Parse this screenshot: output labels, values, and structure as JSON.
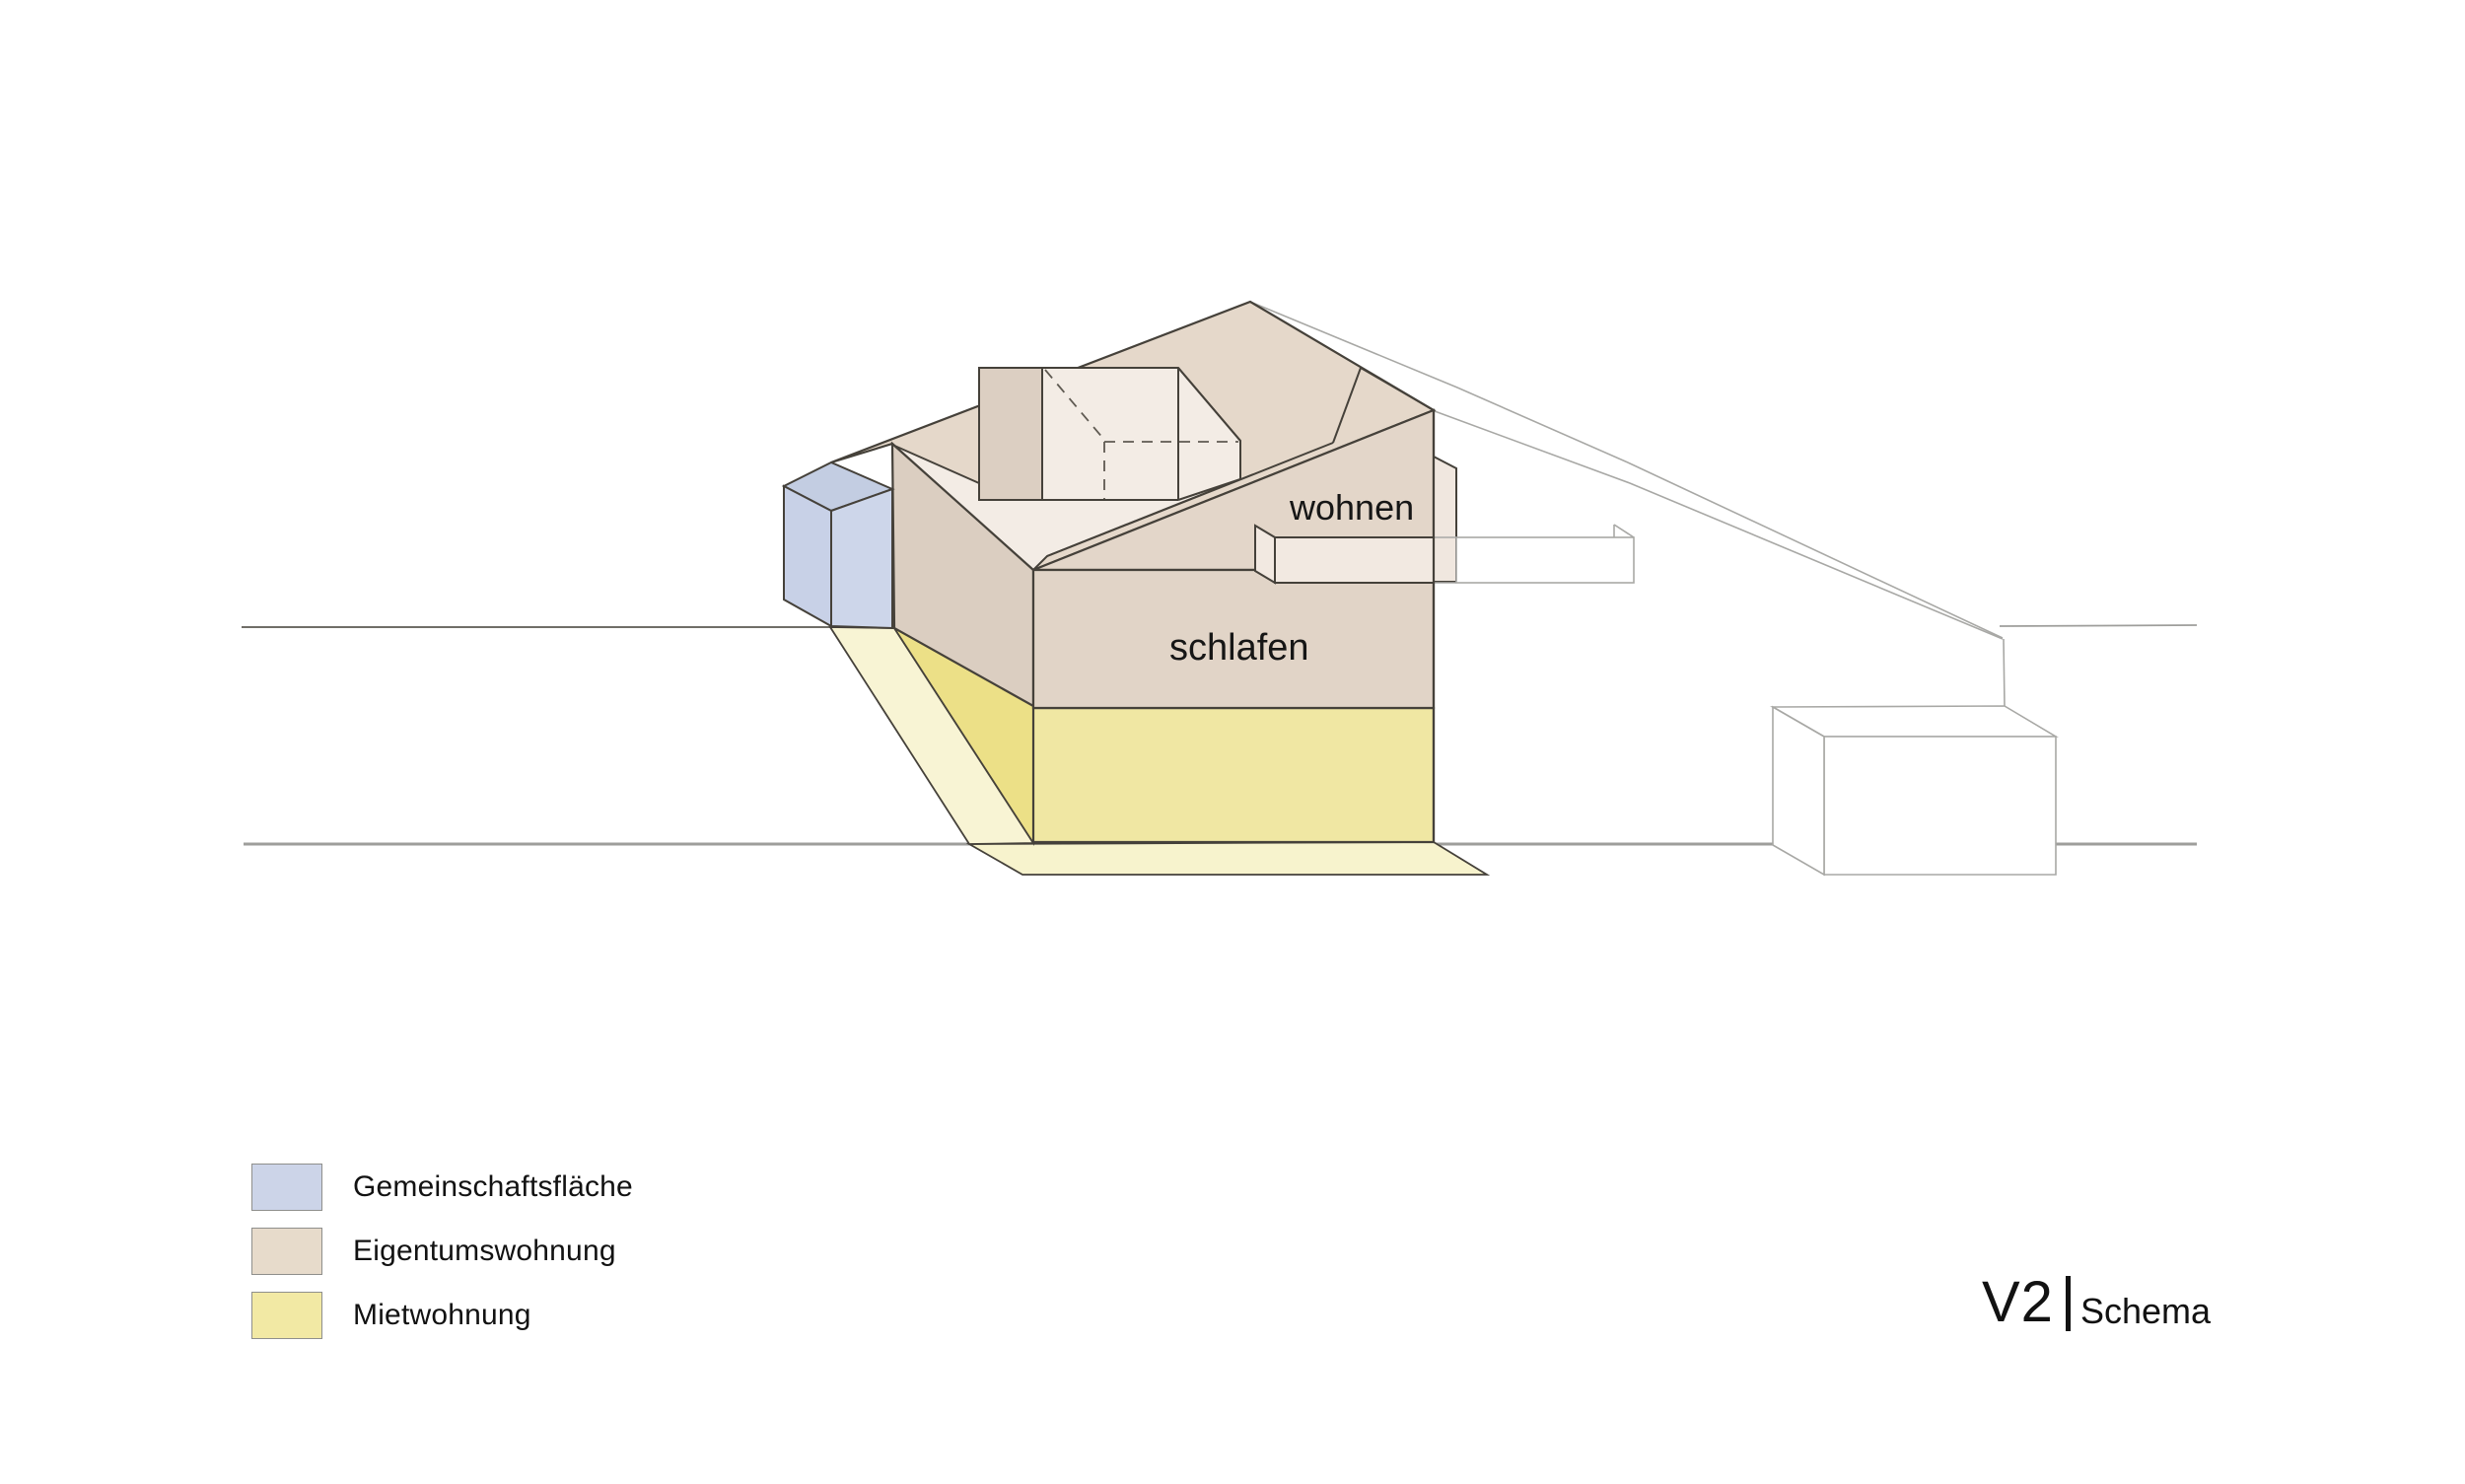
{
  "diagram": {
    "labels": {
      "living": "wohnen",
      "sleeping": "schlafen"
    }
  },
  "legend": {
    "items": [
      {
        "label": "Gemeinschaftsfläche",
        "color": "#ccd4e8"
      },
      {
        "label": "Eigentumswohnung",
        "color": "#e7dbcb"
      },
      {
        "label": "Mietwohnung",
        "color": "#f2e9a4"
      }
    ]
  },
  "title": {
    "version": "V2",
    "separator": "|",
    "name": "Schema"
  },
  "colors": {
    "outline": "#45413a",
    "thin_line": "#a8a8a5",
    "ground_line_dark": "#5c5953",
    "ground_line_light": "#9e9e9b",
    "roof_deck": "#e5d8ca",
    "left_face": "#dbcec1",
    "front_face": "#e1d4c7",
    "courtyard": "#f3ece5",
    "tower": "#dccfc2",
    "balcony": "#f2e9e1",
    "yellow_front": "#f0e7a3",
    "yellow_wedge": "#ece087",
    "yellow_ramp": "#f8f4d4",
    "yellow_ground": "#f7f3cd",
    "blue_top": "#c3cde2",
    "blue_left": "#c8d1e7",
    "blue_right": "#cdd6ea"
  }
}
